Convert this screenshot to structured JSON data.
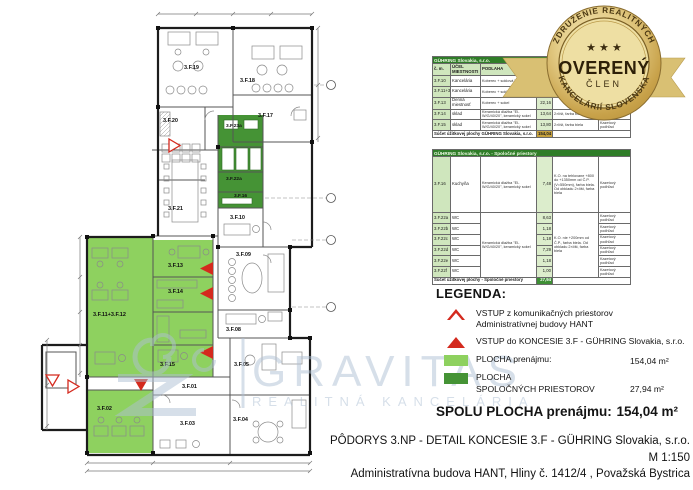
{
  "plan": {
    "rooms": {
      "f19": "3.F.19",
      "f18": "3.F.18",
      "f20": "3.F.20",
      "f17": "3.F.17",
      "f23a": "3.F.23a",
      "f22a": "3.F.22a",
      "f16": "3.F.16",
      "f21": "3.F.21",
      "f10": "3.F.10",
      "f09": "3.F.09",
      "f08": "3.F.08",
      "f13": "3.F.13",
      "f14": "3.F.14",
      "f1112": "3.F.11+3.F.12",
      "f15": "3.F.15",
      "f05": "3.F.05",
      "f01": "3.F.01",
      "f02": "3.F.02",
      "f03": "3.F.03",
      "f04": "3.F.04"
    }
  },
  "watermark": {
    "brand": "GRAVITAS",
    "tagline": "REALITNÁ KANCELÁRIA"
  },
  "badge": {
    "arc_top": "ZDRUŽENIE REALITNÝCH",
    "arc_bottom": "KANCELÁRIÍ SLOVENSKA",
    "stars": "★ ★ ★",
    "center": "OVERENÝ",
    "member": "ČLEN"
  },
  "tables": {
    "t1": {
      "title": "GÜHRING Slovakia, s.r.o.",
      "headers": [
        "č. m.",
        "ÚČEL MIESTNOSTI",
        "PODLAHA",
        "PLOCHA m²",
        "POVRCH STIEN",
        "STROP"
      ],
      "rows": [
        [
          "3.F.10",
          "Kancelária",
          "Koberec + soklová lišta",
          "16,00",
          "",
          "Kazetový podhľad"
        ],
        [
          "3.F.11+3.F.12",
          "Kancelária",
          "Koberec + soklová lišta",
          "88,44",
          "",
          "Kazetový podhľad"
        ],
        [
          "3.F.13",
          "Denná miestnosť",
          "Koberec + sokel",
          "22,16",
          "",
          "Kazetový podhľad"
        ],
        [
          "3.F.14",
          "sklad",
          "Keramická dlažba \"EI-W/G/40/20\", keramický sokel",
          "13,64",
          "2×líšt, farba biela",
          "Kazetový podhľad"
        ],
        [
          "3.F.15",
          "sklad",
          "Keramická dlažba \"EI-W/G/40/20\", keramický sokel",
          "13,80",
          "2×líšt, farba biela",
          "Kazetový podhľad"
        ]
      ],
      "footer_label": "Súčet úžitkovej plochy GÜHRING Slovakia, s.r.o.",
      "footer_value": "154,04"
    },
    "t2": {
      "title": "GÜHRING Slovakia, s.r.o. - Spoločné priestory",
      "rows": [
        [
          "3.F.16",
          "Kuchyňa",
          "Keramická dlažba \"EI-W/G/40/20\", keramický sokel",
          "7,48",
          "K.O. na tehlovane +800 do +1350mm od Č.P. (V=550mm), farba biela. Od obkladu 2×líšt, farba biela",
          "Kazetový podhľad"
        ],
        [
          "3.F.22a",
          "WC",
          "8,63",
          "Kazetový podhľad"
        ],
        [
          "3.F.22b",
          "WC",
          "1,18",
          "Kazetový podhľad"
        ],
        [
          "3.F.22c",
          "WC",
          "1,18",
          "Kazetový podhľad"
        ],
        [
          "3.F.22d",
          "WC",
          "7,29",
          "Kazetový podhľad"
        ],
        [
          "3.F.22e",
          "WC",
          "1,18",
          "Kazetový podhľad"
        ],
        [
          "3.F.22f",
          "WC",
          "1,00",
          "Kazetový podhľad"
        ]
      ],
      "merged_note": "Keramická dlažba \"EI-W/G/40/20\", keramický sokel",
      "wc_note": "K.O. nie +200mm od Č.P., farba biela. Od obkladu 2×líšt, farba biela",
      "footer_label": "Súčet úžitkovej plochy - Spoločné priestory",
      "footer_value": "27,94"
    }
  },
  "legend": {
    "heading": "LEGENDA:",
    "entry1_line1": "VSTUP z komunikačných priestorov",
    "entry1_line2": "Administratívnej budovy HANT",
    "entry2": "VSTUP do KONCESIE 3.F - GÜHRING Slovakia, s.r.o.",
    "area1_label": "PLOCHA prenájmu:",
    "area1_value": "154,04 m²",
    "area2_label1": "PLOCHA",
    "area2_label2": "SPOLOČNÝCH PRIESTOROV",
    "area2_value": "27,94 m²",
    "total_label": "SPOLU PLOCHA prenájmu:",
    "total_value": "154,04 m²"
  },
  "title_block": {
    "line1": "PÔDORYS 3.NP - DETAIL KONCESIE 3.F - GÜHRING Slovakia, s.r.o.",
    "line2": "M  1:150",
    "line3": "Administratívna budova HANT, Hliny č. 1412/4 , Považská Bystrica"
  },
  "colors": {
    "area_rent": "#8ed15f",
    "area_common": "#459335",
    "entry_red": "#d42a1e",
    "table_header_green": "#2f7d28",
    "badge_gold": "#caa54f",
    "watermark_blue": "#aec0d4"
  }
}
